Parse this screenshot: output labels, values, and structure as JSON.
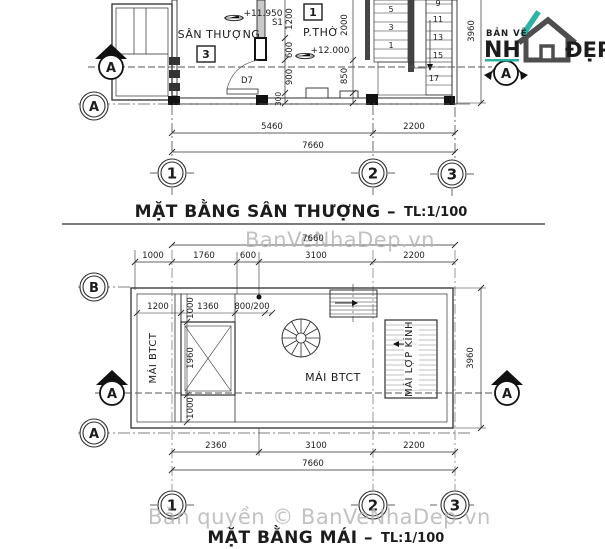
{
  "watermarks": {
    "top": "BanVeNhaDep.vn",
    "bottom": "Bản quyền © BanVeNhaDep.vn"
  },
  "logo": {
    "ban_ve": "BẢN VẼ",
    "nh": "NH",
    "dep": "ĐẸP",
    "teal": "#2bb3a3",
    "dark": "#4e4e4e"
  },
  "plan_top": {
    "title": "MẶT BẰNG SÂN THƯỢNG –",
    "scale": "TL:1/100",
    "rooms": {
      "terrace": "SÂN THƯỢNG",
      "terrace_no": "3",
      "worship": "P.THỜ",
      "worship_no": "1"
    },
    "levels": {
      "terrace": "+11.950",
      "worship": "+12.000"
    },
    "door": "D7",
    "wall_label": "S1",
    "stair_left_steps": [
      "5",
      "3",
      "1"
    ],
    "stair_right_steps": [
      "9",
      "11",
      "13",
      "15",
      "17"
    ],
    "dims_left_chain": [
      "1200",
      "600",
      "900",
      "300"
    ],
    "dims_mid_chain": [
      "2000",
      "850"
    ],
    "dim_height": "3960",
    "dims_bottom": [
      "5460",
      "2200"
    ],
    "dim_total": "7660",
    "grid_cols": [
      "1",
      "2",
      "3"
    ],
    "grid_row": "A",
    "section_left": "A",
    "section_right": "A"
  },
  "plan_bottom": {
    "title": "MẶT BẰNG MÁI –",
    "scale": "TL:1/100",
    "labels": {
      "strip": "MÁI BTCT",
      "main": "MÁI BTCT",
      "glass": "MÁI LỢP KÍNH"
    },
    "dim_total_top": "7660",
    "dims_top": [
      "1000",
      "1760",
      "600",
      "3100",
      "2200"
    ],
    "dims_inner_h": [
      "1200",
      "1360",
      "800/200"
    ],
    "dims_inner_v": [
      "1000",
      "1960",
      "1000"
    ],
    "dim_height": "3960",
    "dims_bottom": [
      "2360",
      "3100",
      "2200"
    ],
    "dim_total_bottom": "7660",
    "grid_cols": [
      "1",
      "2",
      "3"
    ],
    "grid_row_top": "B",
    "grid_row_bottom": "A",
    "section_left": "A",
    "section_right": "A"
  }
}
